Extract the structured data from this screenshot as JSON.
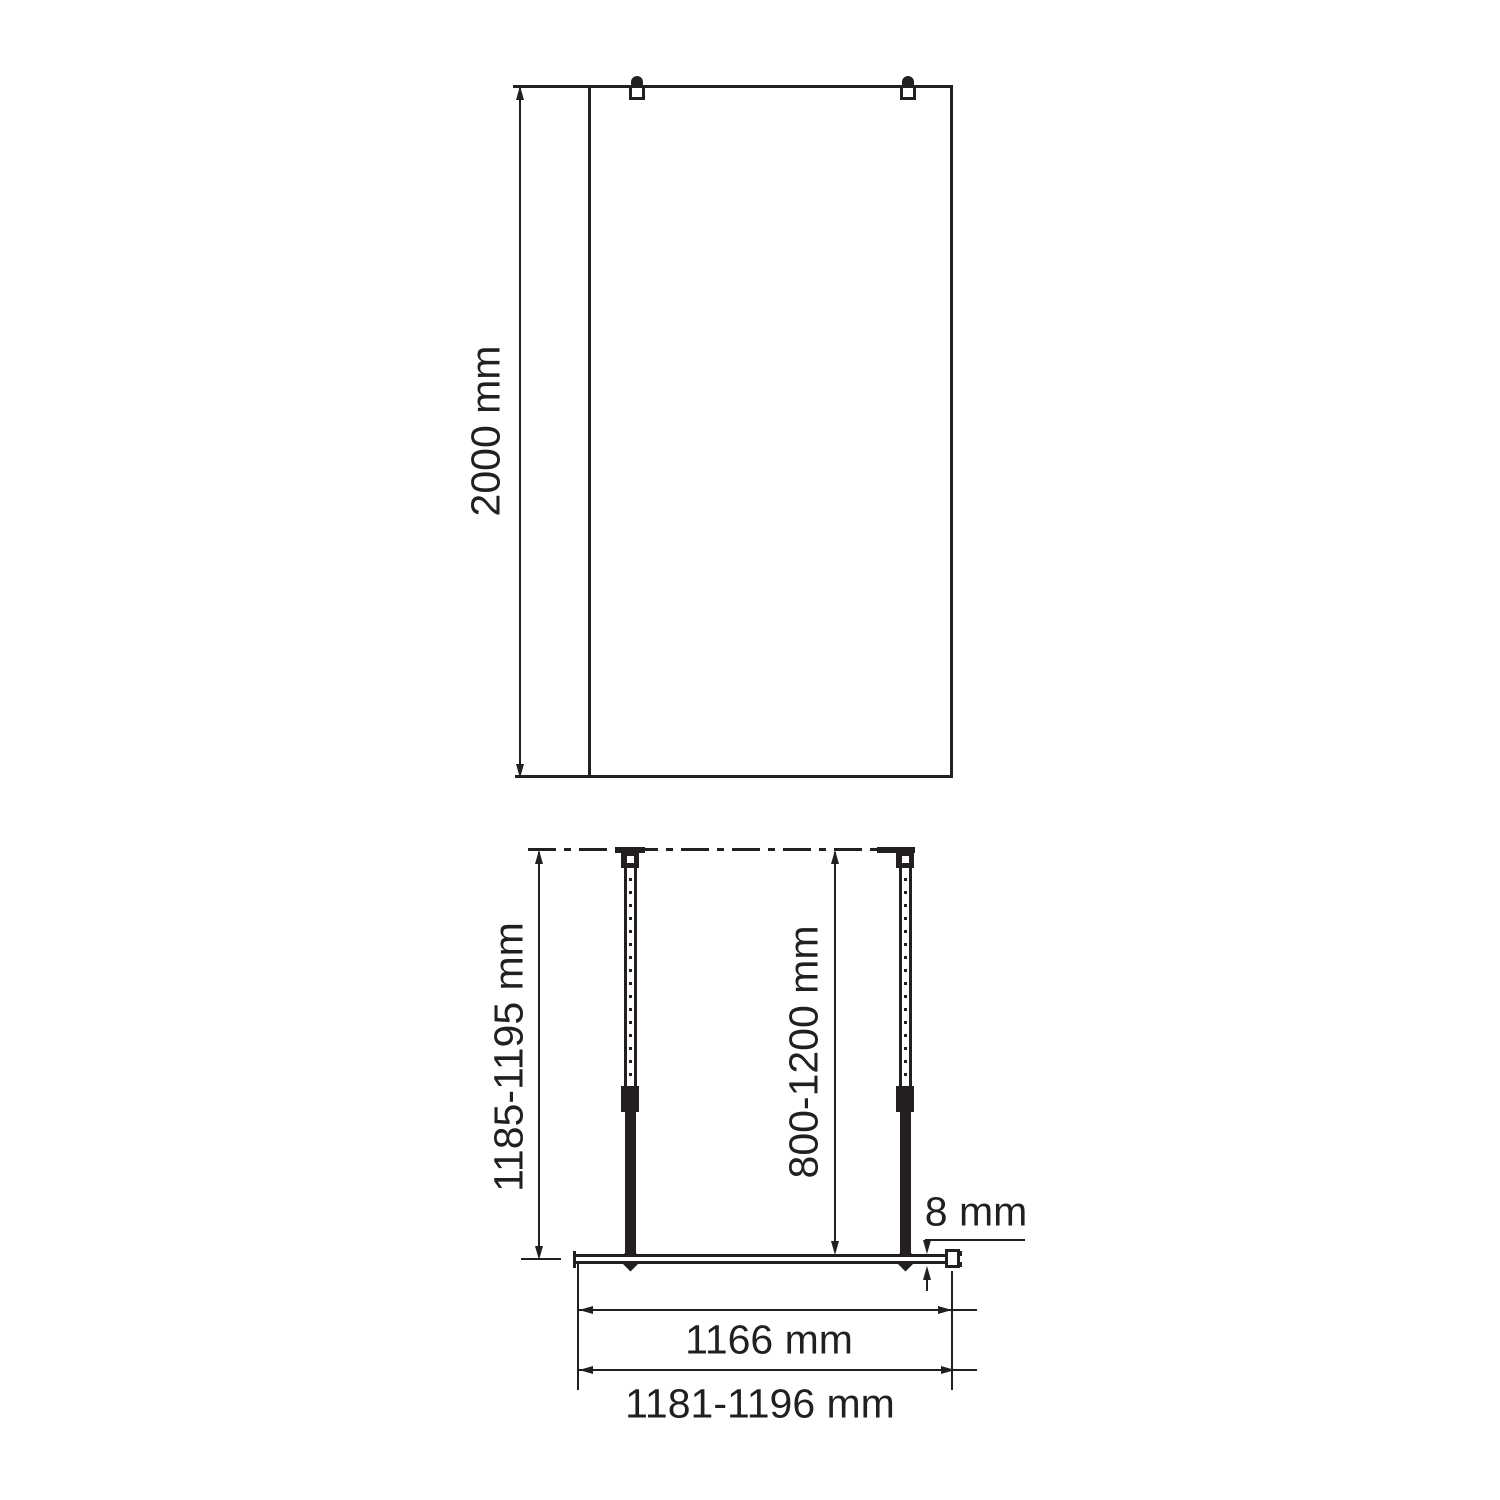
{
  "drawing": {
    "background_color": "#ffffff",
    "line_color": "#231f20",
    "front_view": {
      "height_label": "2000 mm"
    },
    "plan_view": {
      "wall_to_glass_label": "1185-1195 mm",
      "support_bar_label": "800-1200 mm",
      "glass_thickness_label": "8 mm",
      "glass_width_label": "1166 mm",
      "overall_width_label": "1181-1196 mm"
    }
  }
}
